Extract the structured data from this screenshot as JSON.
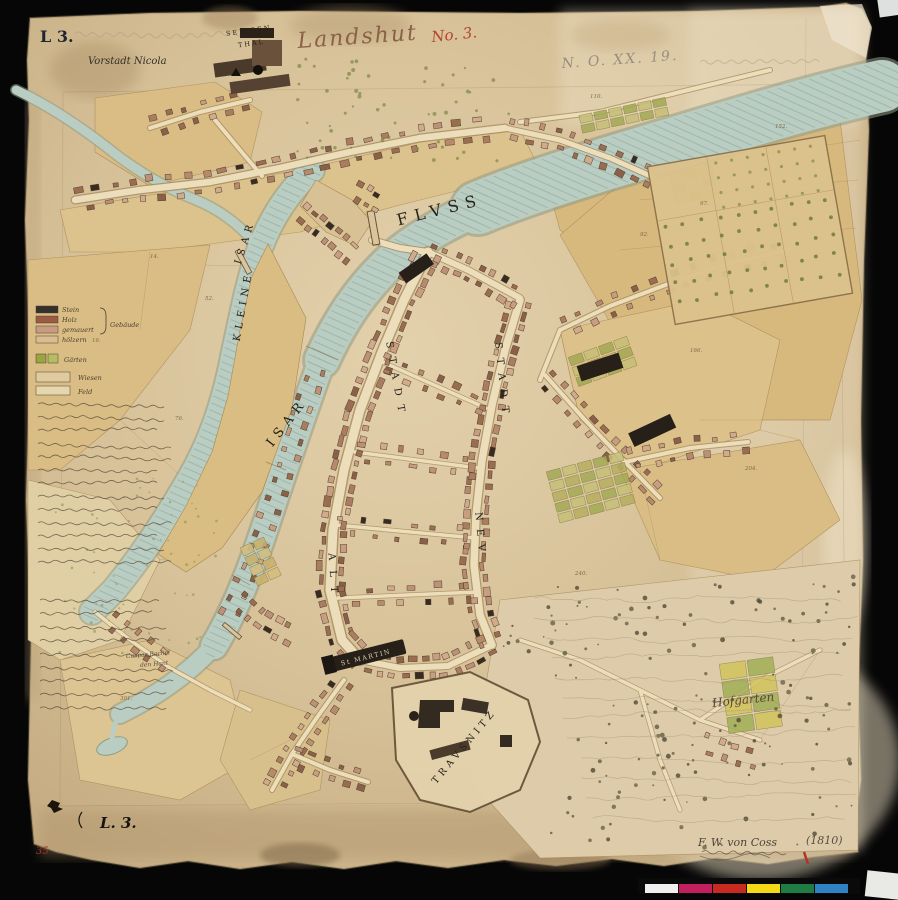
{
  "stamps": {
    "top_left": "L 3.",
    "bottom_left": "L. 3.",
    "red_margin_number": "35"
  },
  "inscriptions": {
    "city_script": "Landshut",
    "red_sheet_no": "No. 3.",
    "pencil_archive_no": "N. O. XX. 19.",
    "signature": "F. W. von Coss",
    "year": "(1810)"
  },
  "place_labels": {
    "vorstadt_nicola": "Vorstadt Nicola",
    "seligenthal_line1": "SELIGEN",
    "seligenthal_line2": "THAL",
    "fluss": "FLVSS",
    "isar_upper": "ISAR",
    "kleine": "KLEINE",
    "isar_lower": "ISAR",
    "altstadt_upper": "STADT",
    "altstadt_lower": "ALT",
    "neustadt_upper": "STADT",
    "neustadt_lower": "NEV",
    "st_martin": "St MARTIN",
    "trausnitz": "TRAVSNITZ",
    "hofgarten": "Hofgarten",
    "owner_line1": "Caspar Bachel",
    "owner_line2": "den Hant"
  },
  "legend": {
    "materials": [
      {
        "label": "Stein",
        "color": "#35302a"
      },
      {
        "label": "Holz",
        "color": "#9c5a43"
      },
      {
        "label": "gemauert",
        "color": "#c89c82"
      },
      {
        "label": "hölzern",
        "color": "#d9bd8e"
      }
    ],
    "group_label": "Gebäude",
    "land": [
      {
        "label": "Gärten",
        "color": "#9aa441"
      },
      {
        "label": "Wiesen",
        "color": "#e0cb9e"
      },
      {
        "label": "Feld",
        "color": "#e6d6ae"
      }
    ]
  },
  "plot_numbers": [
    "14.",
    "16.",
    "52.",
    "76.",
    "92.",
    "97.",
    "110.",
    "152.",
    "166.",
    "204.",
    "240.",
    "301."
  ],
  "color_bar": {
    "segments": [
      "#f0f0ee",
      "#c21f5e",
      "#c62a20",
      "#f5d917",
      "#1f7c42",
      "#2f82c4"
    ]
  }
}
